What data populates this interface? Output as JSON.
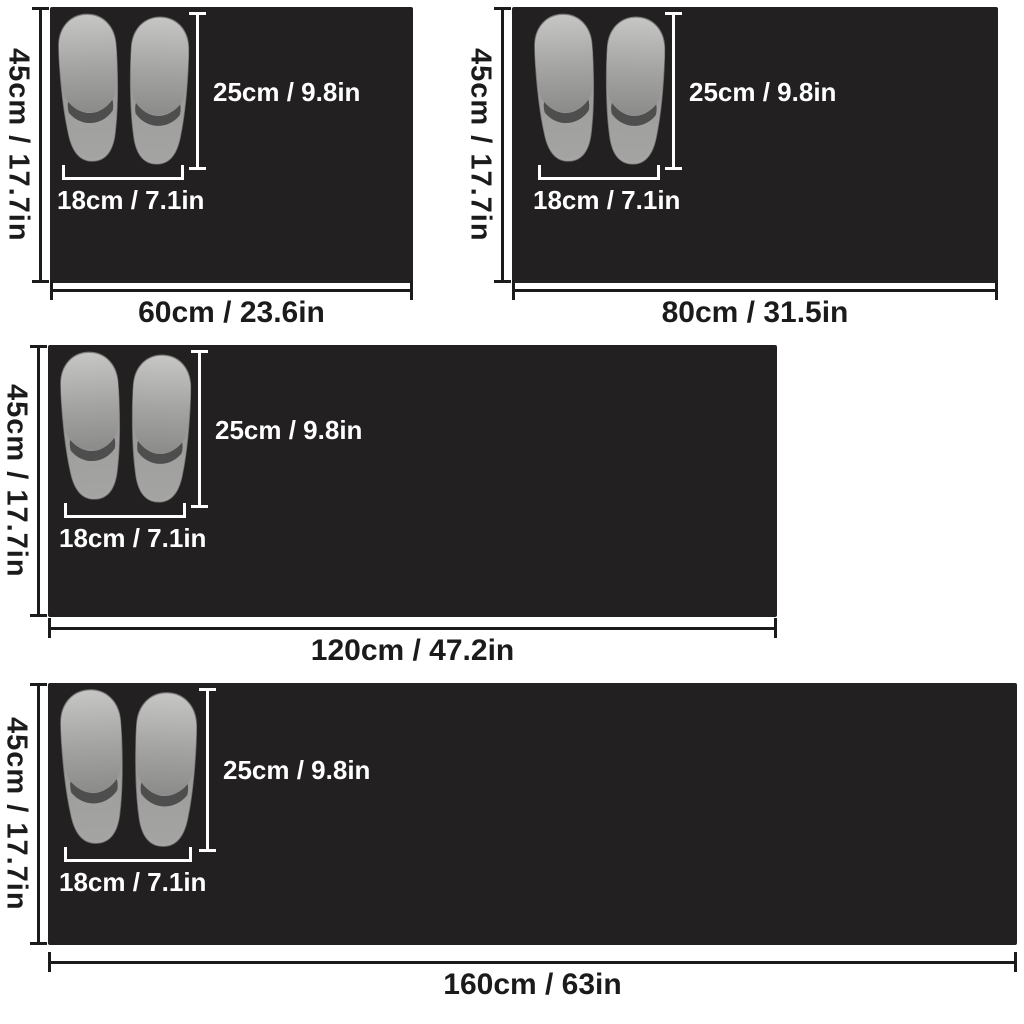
{
  "page": {
    "background": "#ffffff"
  },
  "colors": {
    "mat": "#222020",
    "outer_dimension": "#1c1b1b",
    "inner_dimension": "#ffffff",
    "slipper_gray": "#9a9a98"
  },
  "annotations": {
    "mat_height_label": "45cm / 17.7in",
    "slipper_length_label": "25cm / 9.8in",
    "slipper_width_label": "18cm / 7.1in"
  },
  "mats": [
    {
      "id": "mat-60cm",
      "width_label": "60cm / 23.6in"
    },
    {
      "id": "mat-80cm",
      "width_label": "80cm / 31.5in"
    },
    {
      "id": "mat-120cm",
      "width_label": "120cm / 47.2in"
    },
    {
      "id": "mat-160cm",
      "width_label": "160cm / 63in"
    }
  ]
}
